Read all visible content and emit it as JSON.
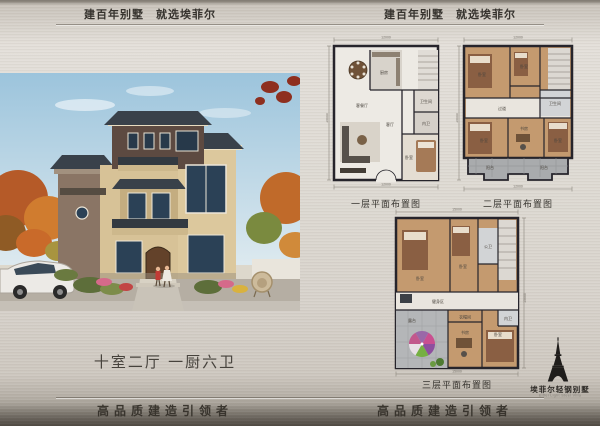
{
  "page": {
    "header_left": "建百年别墅　就选埃菲尔",
    "header_right": "建百年别墅　就选埃菲尔",
    "footer_left": "高品质建造引领者",
    "footer_right": "高品质建造引领者"
  },
  "villa": {
    "caption": "十室二厅 一厨六卫"
  },
  "plans": [
    {
      "label": "一层平面布置图",
      "rooms": [
        "客餐厅",
        "厨房",
        "客厅",
        "卧室",
        "内卫",
        "卫生间"
      ],
      "dims": {
        "width": "12000",
        "height": "15000"
      }
    },
    {
      "label": "二层平面布置图",
      "rooms": [
        "卧室",
        "卧室",
        "卫生间",
        "过道",
        "卧室",
        "书房",
        "卧室",
        "阳台",
        "阳台"
      ],
      "dims": {
        "width": "12000",
        "height": "15000"
      }
    },
    {
      "label": "三层平面布置图",
      "rooms": [
        "卧室",
        "卧室",
        "公卫",
        "健身区",
        "露台",
        "衣帽间",
        "书房",
        "卧室",
        "内卫"
      ],
      "dims": {
        "width": "15000",
        "height": "15000"
      }
    }
  ],
  "logo": {
    "title": "埃菲尔轻钢别墅",
    "subtitle": "Eiffel Light Steel Villa",
    "icon": "eiffel-tower-icon"
  },
  "colors": {
    "metal_light": "#e3dfd9",
    "metal_dark": "#6c665f",
    "wall_ink": "#26242b",
    "wood_floor": "#c49a6f",
    "villa_beige": "#d7c297",
    "roof_slate": "#39414a"
  }
}
